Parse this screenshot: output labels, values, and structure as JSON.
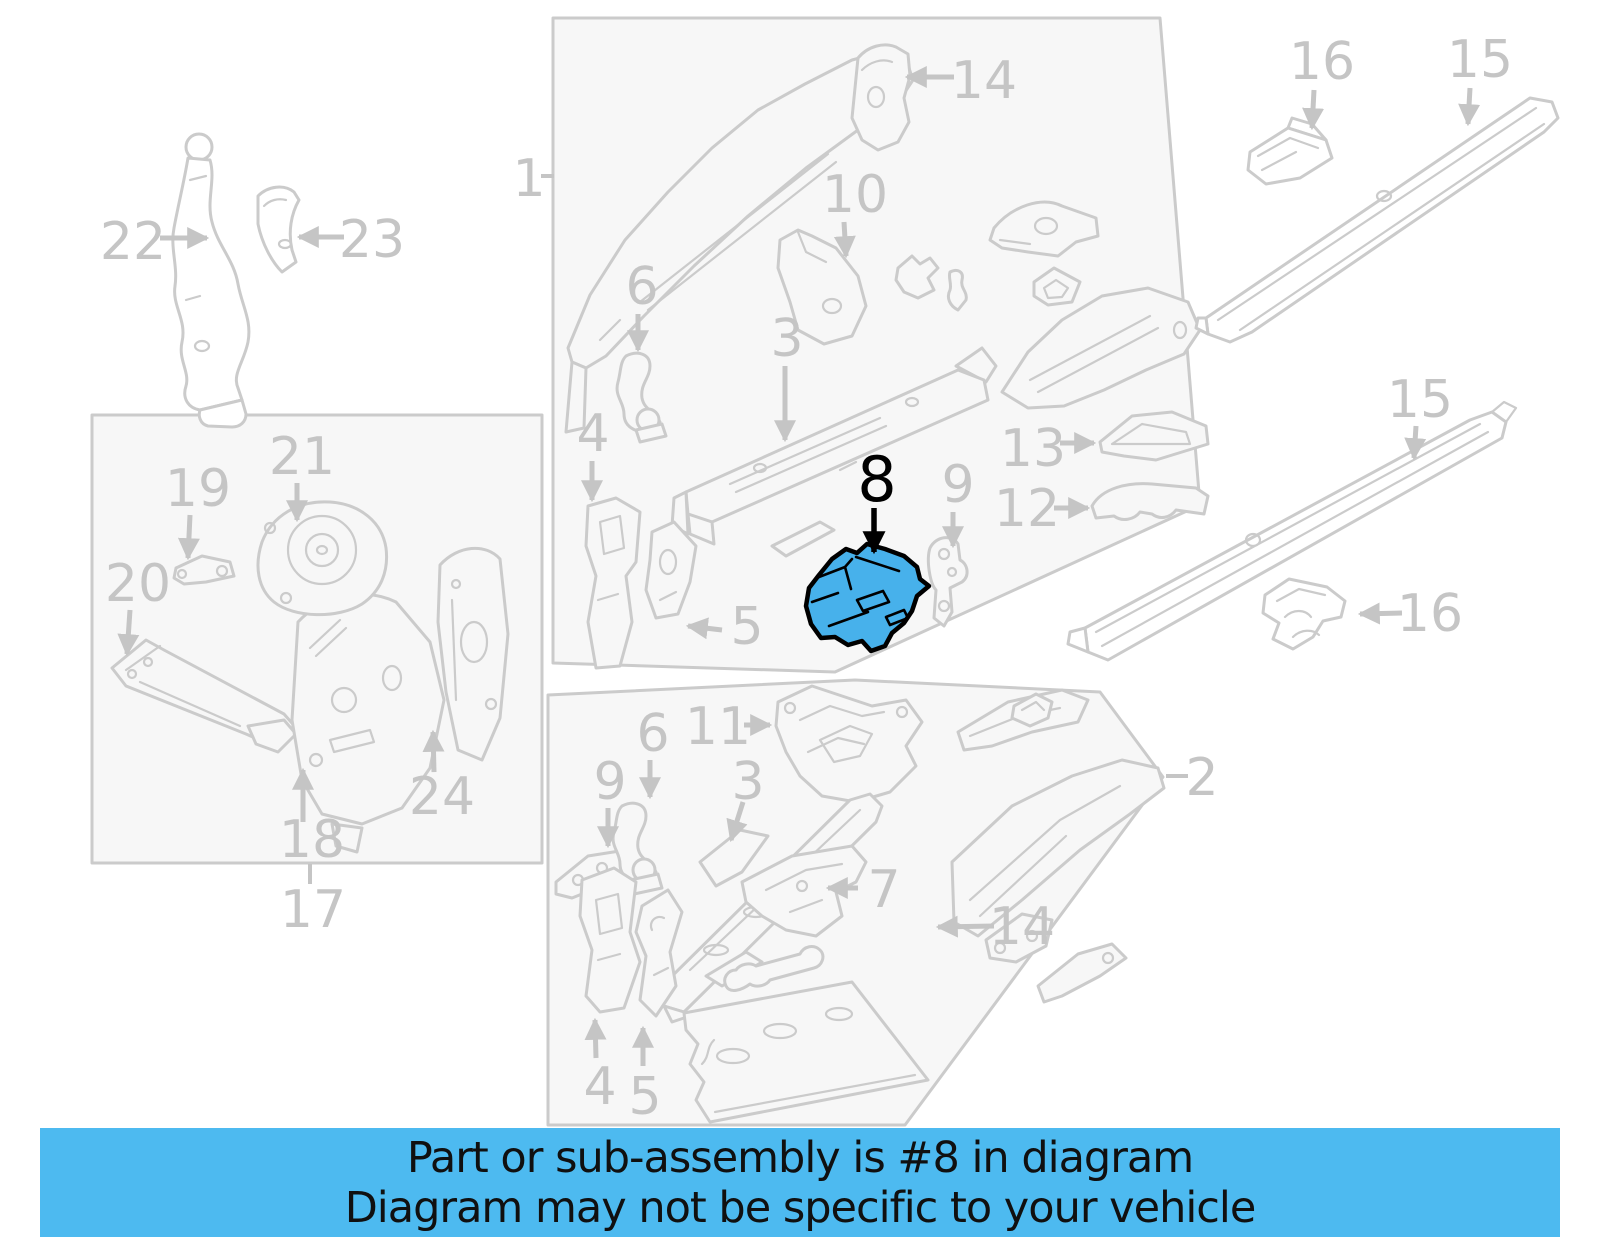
{
  "banner": {
    "line1": "Part or sub-assembly is #8 in diagram",
    "line2": "Diagram may not be specific to your vehicle"
  },
  "colors": {
    "accent": "#47B1EB",
    "accent_outline": "#000000",
    "banner_bg": "#4DBAF0",
    "banner_text": "#101010",
    "line": "#cbcbcb",
    "label": "#c5c5c5",
    "box_fill": "#f7f7f7",
    "background": "#ffffff"
  },
  "diagram": {
    "highlighted_part": "8",
    "callouts": [
      {
        "id": "22",
        "label": "22",
        "x": 133,
        "y": 240,
        "arrow": {
          "x1": 160,
          "y1": 238,
          "x2": 207,
          "y2": 238
        }
      },
      {
        "id": "23",
        "label": "23",
        "x": 372,
        "y": 238,
        "arrow": {
          "x1": 344,
          "y1": 237,
          "x2": 299,
          "y2": 237
        }
      },
      {
        "id": "1",
        "label": "1",
        "x": 529,
        "y": 177,
        "tick": {
          "x1": 541,
          "y1": 176,
          "x2": 554,
          "y2": 176
        }
      },
      {
        "id": "14-top",
        "label": "14",
        "x": 984,
        "y": 79,
        "arrow": {
          "x1": 954,
          "y1": 77,
          "x2": 907,
          "y2": 77
        }
      },
      {
        "id": "16-top",
        "label": "16",
        "x": 1322,
        "y": 60,
        "arrow": {
          "x1": 1314,
          "y1": 90,
          "x2": 1312,
          "y2": 128
        }
      },
      {
        "id": "15-top",
        "label": "15",
        "x": 1480,
        "y": 58,
        "arrow": {
          "x1": 1470,
          "y1": 88,
          "x2": 1468,
          "y2": 124
        }
      },
      {
        "id": "10",
        "label": "10",
        "x": 855,
        "y": 193,
        "arrow": {
          "x1": 844,
          "y1": 222,
          "x2": 846,
          "y2": 256
        }
      },
      {
        "id": "6-top",
        "label": "6",
        "x": 642,
        "y": 285,
        "arrow": {
          "x1": 638,
          "y1": 314,
          "x2": 638,
          "y2": 350
        }
      },
      {
        "id": "3-top",
        "label": "3",
        "x": 787,
        "y": 337,
        "arrow": {
          "x1": 785,
          "y1": 366,
          "x2": 785,
          "y2": 440
        }
      },
      {
        "id": "4-top",
        "label": "4",
        "x": 593,
        "y": 432,
        "arrow": {
          "x1": 592,
          "y1": 461,
          "x2": 592,
          "y2": 500
        }
      },
      {
        "id": "8",
        "label": "8",
        "x": 877,
        "y": 479,
        "color": "black",
        "size": 62,
        "arrow": {
          "x1": 874,
          "y1": 508,
          "x2": 874,
          "y2": 552
        }
      },
      {
        "id": "9-top",
        "label": "9",
        "x": 958,
        "y": 483,
        "arrow": {
          "x1": 953,
          "y1": 512,
          "x2": 953,
          "y2": 546
        }
      },
      {
        "id": "13",
        "label": "13",
        "x": 1033,
        "y": 447,
        "arrow": {
          "x1": 1060,
          "y1": 443,
          "x2": 1094,
          "y2": 443
        }
      },
      {
        "id": "12",
        "label": "12",
        "x": 1027,
        "y": 507,
        "arrow": {
          "x1": 1054,
          "y1": 508,
          "x2": 1088,
          "y2": 508
        }
      },
      {
        "id": "5-top",
        "label": "5",
        "x": 747,
        "y": 625,
        "arrow": {
          "x1": 722,
          "y1": 630,
          "x2": 688,
          "y2": 626
        }
      },
      {
        "id": "15-mid",
        "label": "15",
        "x": 1420,
        "y": 398,
        "arrow": {
          "x1": 1416,
          "y1": 426,
          "x2": 1414,
          "y2": 458
        }
      },
      {
        "id": "16-mid",
        "label": "16",
        "x": 1430,
        "y": 612,
        "arrow": {
          "x1": 1402,
          "y1": 613,
          "x2": 1360,
          "y2": 614
        }
      },
      {
        "id": "2",
        "label": "2",
        "x": 1202,
        "y": 776,
        "tick": {
          "x1": 1166,
          "y1": 776,
          "x2": 1188,
          "y2": 776
        }
      },
      {
        "id": "19",
        "label": "19",
        "x": 198,
        "y": 487,
        "arrow": {
          "x1": 190,
          "y1": 515,
          "x2": 188,
          "y2": 558
        }
      },
      {
        "id": "21",
        "label": "21",
        "x": 302,
        "y": 455,
        "arrow": {
          "x1": 297,
          "y1": 483,
          "x2": 297,
          "y2": 520
        }
      },
      {
        "id": "20",
        "label": "20",
        "x": 138,
        "y": 582,
        "arrow": {
          "x1": 130,
          "y1": 610,
          "x2": 127,
          "y2": 654
        }
      },
      {
        "id": "24",
        "label": "24",
        "x": 442,
        "y": 795,
        "arrow": {
          "x1": 434,
          "y1": 772,
          "x2": 433,
          "y2": 732
        }
      },
      {
        "id": "18",
        "label": "18",
        "x": 312,
        "y": 838,
        "arrow": {
          "x1": 303,
          "y1": 822,
          "x2": 303,
          "y2": 770
        }
      },
      {
        "id": "17",
        "label": "17",
        "x": 313,
        "y": 908,
        "tick": {
          "x1": 310,
          "y1": 864,
          "x2": 310,
          "y2": 884
        }
      },
      {
        "id": "6-bottom",
        "label": "6",
        "x": 653,
        "y": 732,
        "arrow": {
          "x1": 650,
          "y1": 760,
          "x2": 650,
          "y2": 797
        }
      },
      {
        "id": "11",
        "label": "11",
        "x": 718,
        "y": 725,
        "arrow": {
          "x1": 744,
          "y1": 725,
          "x2": 770,
          "y2": 725
        }
      },
      {
        "id": "9-bottom",
        "label": "9",
        "x": 610,
        "y": 780,
        "arrow": {
          "x1": 608,
          "y1": 808,
          "x2": 608,
          "y2": 846
        }
      },
      {
        "id": "3-bottom",
        "label": "3",
        "x": 748,
        "y": 780,
        "arrow": {
          "x1": 743,
          "y1": 802,
          "x2": 731,
          "y2": 840
        }
      },
      {
        "id": "7",
        "label": "7",
        "x": 884,
        "y": 888,
        "arrow": {
          "x1": 858,
          "y1": 888,
          "x2": 828,
          "y2": 888
        }
      },
      {
        "id": "14-bottom",
        "label": "14",
        "x": 1022,
        "y": 925,
        "arrow": {
          "x1": 994,
          "y1": 926,
          "x2": 938,
          "y2": 927
        }
      },
      {
        "id": "4-bottom",
        "label": "4",
        "x": 600,
        "y": 1085,
        "arrow": {
          "x1": 596,
          "y1": 1058,
          "x2": 595,
          "y2": 1020
        }
      },
      {
        "id": "5-bottom",
        "label": "5",
        "x": 645,
        "y": 1095,
        "arrow": {
          "x1": 643,
          "y1": 1066,
          "x2": 643,
          "y2": 1028
        }
      }
    ]
  }
}
